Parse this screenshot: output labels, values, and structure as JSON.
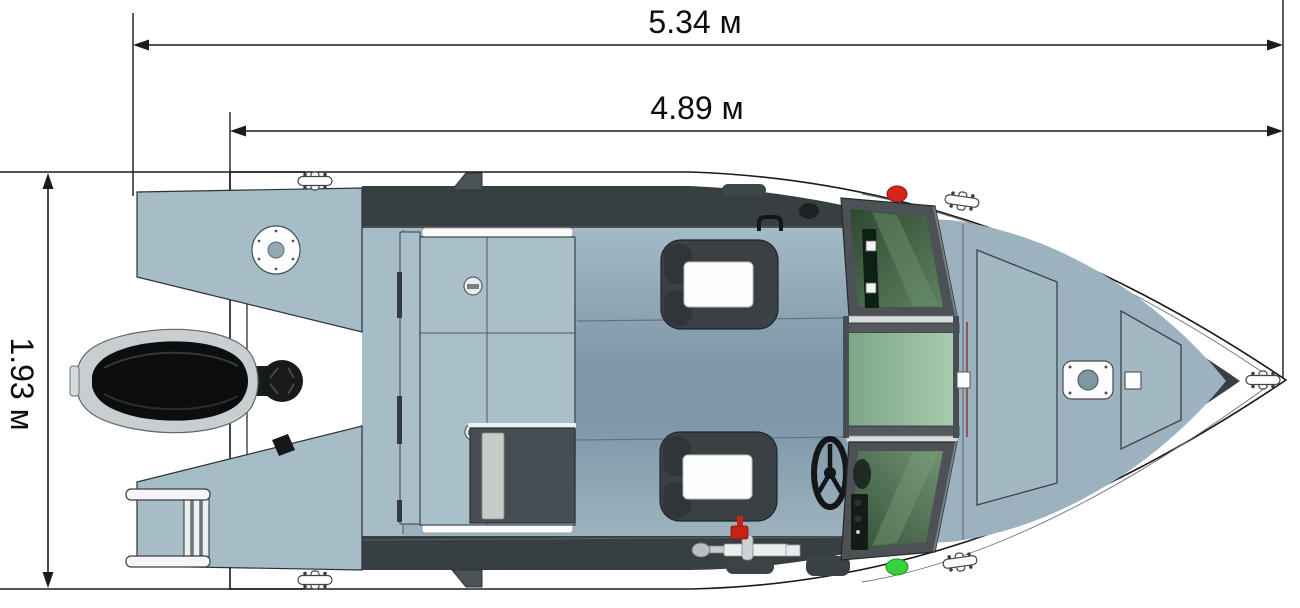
{
  "drawing": {
    "type": "boat-top-view-technical-drawing",
    "view": "plan",
    "units": "м"
  },
  "dimensions": {
    "overall_length": {
      "label": "5.34 м"
    },
    "hull_length": {
      "label": "4.89 м"
    },
    "beam": {
      "label": "1.93 м"
    }
  },
  "colors": {
    "outline": "#1b1b1b",
    "hull_white": "#ffffff",
    "deck_light": "#a6bcc7",
    "floor_top": "#a4bac5",
    "floor_mid": "#7d97a8",
    "gunwale_dark": "#383f43",
    "frame_gray": "#4b5155",
    "seat_dark": "#3a4044",
    "cushion_white": "#fefefe",
    "box_dark": "#454e53",
    "motor_black": "#0c0d0e",
    "motor_silver": "#c9ced1",
    "glass_dark_green": "#3a573e",
    "glass_light_green": "#8fb79a",
    "nav_red": "#d3271c",
    "nav_green": "#37d23c"
  },
  "parts": [
    "hull",
    "transom",
    "port-swim-platform",
    "starboard-swim-platform",
    "boarding-ladder",
    "outboard-motor",
    "steering-knob",
    "inspection-plate",
    "stern-bench-storage",
    "storage-box",
    "passenger-seat",
    "driver-seat",
    "steering-wheel",
    "throttle-control",
    "engine-kill-switch",
    "windshield-port-panel",
    "windshield-walkthrough",
    "windshield-starboard-panel",
    "helm-instruments",
    "port-nav-light",
    "starboard-nav-light",
    "foredeck-hatch",
    "bow-hatch",
    "bow-mount-plate",
    "port-stern-cleat",
    "starboard-stern-cleat",
    "port-bow-cleat",
    "starboard-bow-cleat",
    "bow-tip-cleat",
    "grab-handle"
  ]
}
